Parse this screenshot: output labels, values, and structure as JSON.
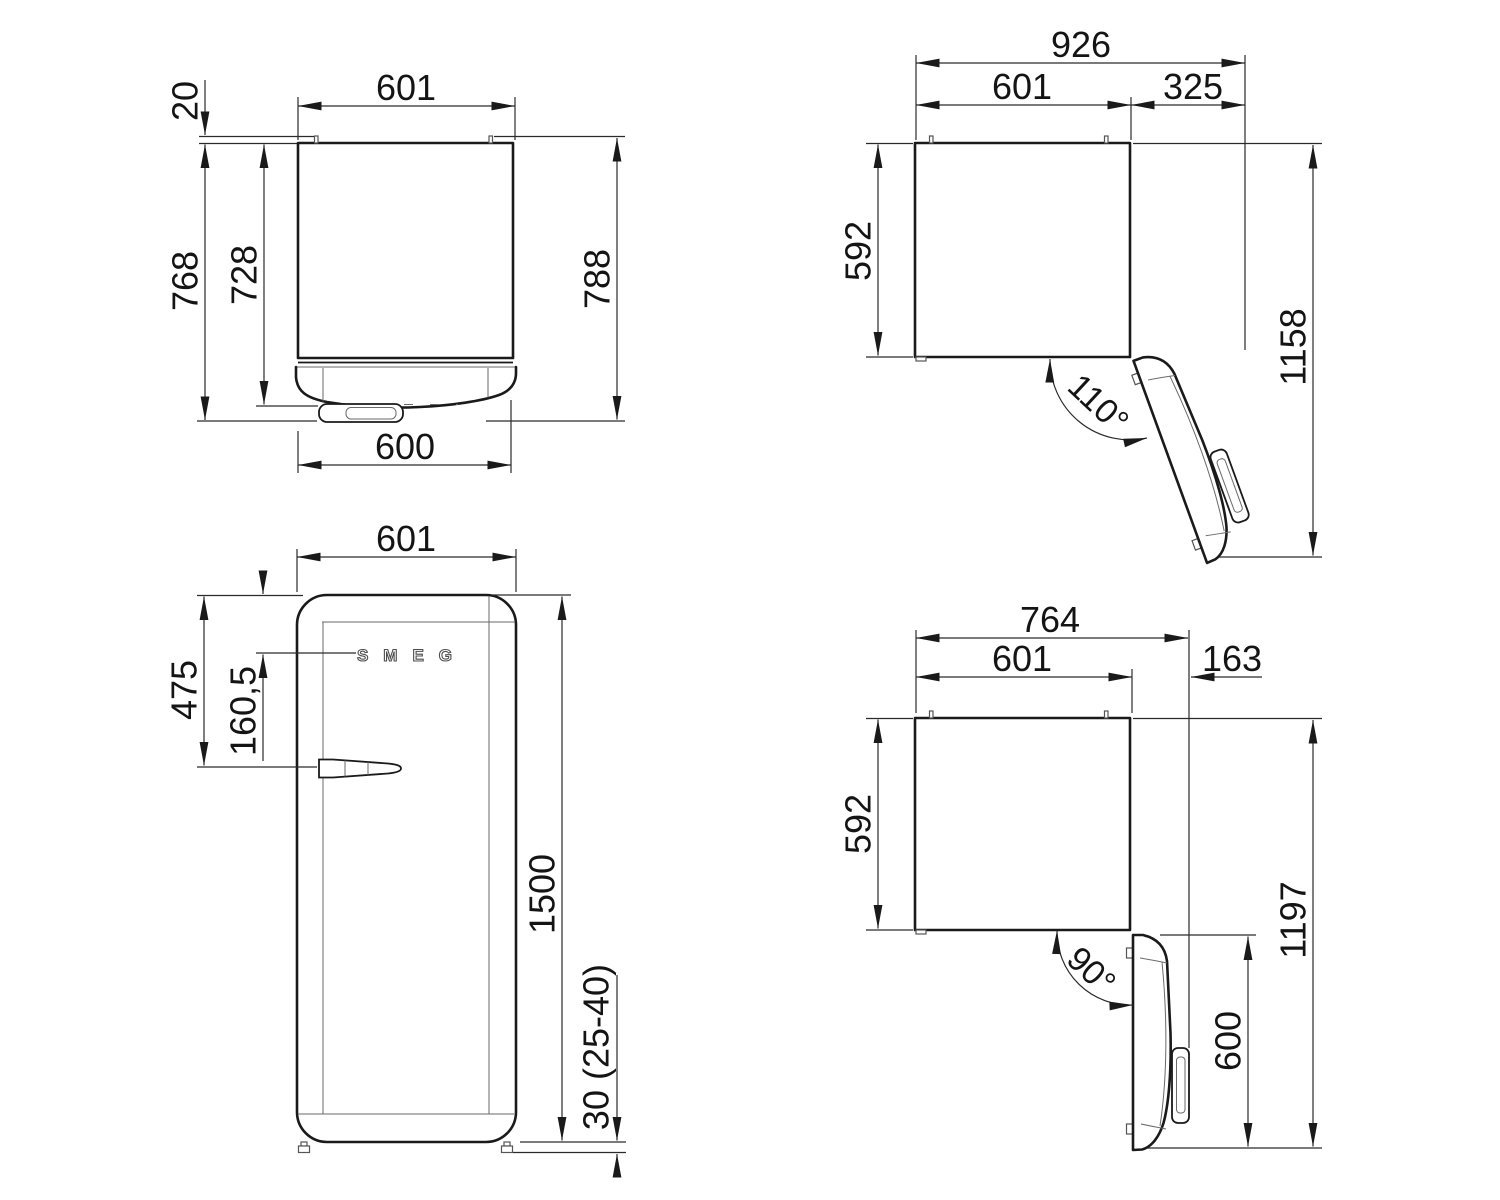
{
  "drawing": {
    "kind": "refrigerator-installation-dimensions",
    "views": {
      "top_closed": {
        "width_top": "601",
        "hinge_protrusion": "20",
        "depth_with_door": "768",
        "depth_body": "728",
        "depth_overall": "788",
        "door_width": "600"
      },
      "top_open_110": {
        "overall_width": "926",
        "cabinet_width": "601",
        "door_side_clearance": "325",
        "cabinet_depth": "592",
        "overall_depth": "1158",
        "door_angle": "110°"
      },
      "front": {
        "width": "601",
        "handle_from_top": "475",
        "logo_from_top": "160,5",
        "height": "1500",
        "feet_height": "30 (25-40)",
        "logo": "SMEG"
      },
      "top_open_90": {
        "overall_width": "764",
        "cabinet_width": "601",
        "door_side_clearance": "163",
        "cabinet_depth": "592",
        "overall_depth": "1197",
        "door_angle": "90°",
        "door_open_width": "600"
      }
    }
  }
}
